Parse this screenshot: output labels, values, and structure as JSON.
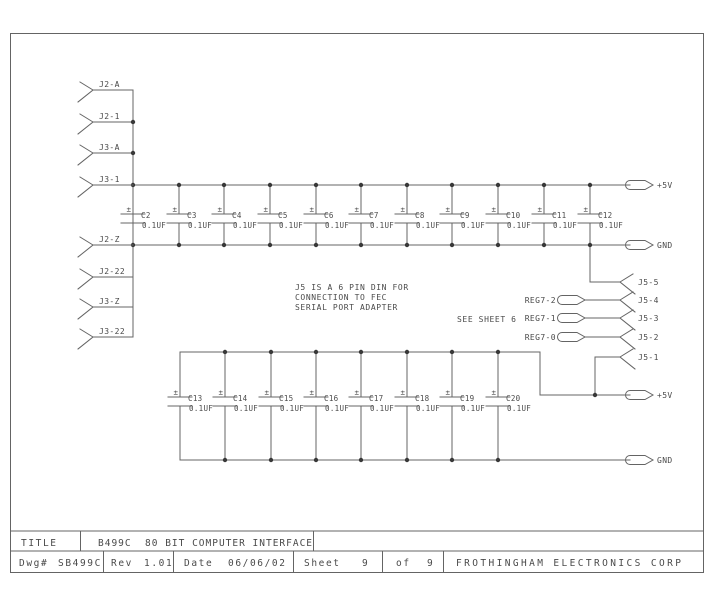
{
  "colors": {
    "line": "#646464",
    "text": "#4a4a4a",
    "dot": "#383838",
    "background": "#ffffff"
  },
  "drawing": {
    "left_connectors": [
      "J2-A",
      "J2-1",
      "J3-A",
      "J3-1",
      "J2-Z",
      "J2-22",
      "J3-Z",
      "J3-22"
    ],
    "j5_connectors": [
      "J5-5",
      "J5-4",
      "J5-3",
      "J5-2",
      "J5-1"
    ],
    "reg_terminals": [
      "REG7-2",
      "REG7-1",
      "REG7-0"
    ],
    "power_terminals": [
      "+5V",
      "GND",
      "+5V",
      "GND"
    ],
    "cap_polarity_mark": "±",
    "top_bank_caps": [
      {
        "ref": "C2",
        "value": "0.1UF"
      },
      {
        "ref": "C3",
        "value": "0.1UF"
      },
      {
        "ref": "C4",
        "value": "0.1UF"
      },
      {
        "ref": "C5",
        "value": "0.1UF"
      },
      {
        "ref": "C6",
        "value": "0.1UF"
      },
      {
        "ref": "C7",
        "value": "0.1UF"
      },
      {
        "ref": "C8",
        "value": "0.1UF"
      },
      {
        "ref": "C9",
        "value": "0.1UF"
      },
      {
        "ref": "C10",
        "value": "0.1UF"
      },
      {
        "ref": "C11",
        "value": "0.1UF"
      },
      {
        "ref": "C12",
        "value": "0.1UF"
      }
    ],
    "bottom_bank_caps": [
      {
        "ref": "C13",
        "value": "0.1UF"
      },
      {
        "ref": "C14",
        "value": "0.1UF"
      },
      {
        "ref": "C15",
        "value": "0.1UF"
      },
      {
        "ref": "C16",
        "value": "0.1UF"
      },
      {
        "ref": "C17",
        "value": "0.1UF"
      },
      {
        "ref": "C18",
        "value": "0.1UF"
      },
      {
        "ref": "C19",
        "value": "0.1UF"
      },
      {
        "ref": "C20",
        "value": "0.1UF"
      }
    ],
    "note_lines": [
      "J5 IS A 6 PIN DIN FOR",
      "CONNECTION TO FEC",
      "SERIAL PORT ADAPTER"
    ],
    "see_sheet_note": "SEE SHEET 6"
  },
  "title_block": {
    "title_label": "TITLE",
    "title": "B499C  80 BIT COMPUTER INTERFACE",
    "dwg_label": "Dwg#",
    "dwg_number": "SB499C",
    "rev_label": "Rev",
    "rev": "1.01",
    "date_label": "Date",
    "date": "06/06/02",
    "sheet_label": "Sheet",
    "sheet": "9",
    "of_label": "of",
    "sheets_total": "9",
    "company": "FROTHINGHAM ELECTRONICS CORP"
  }
}
